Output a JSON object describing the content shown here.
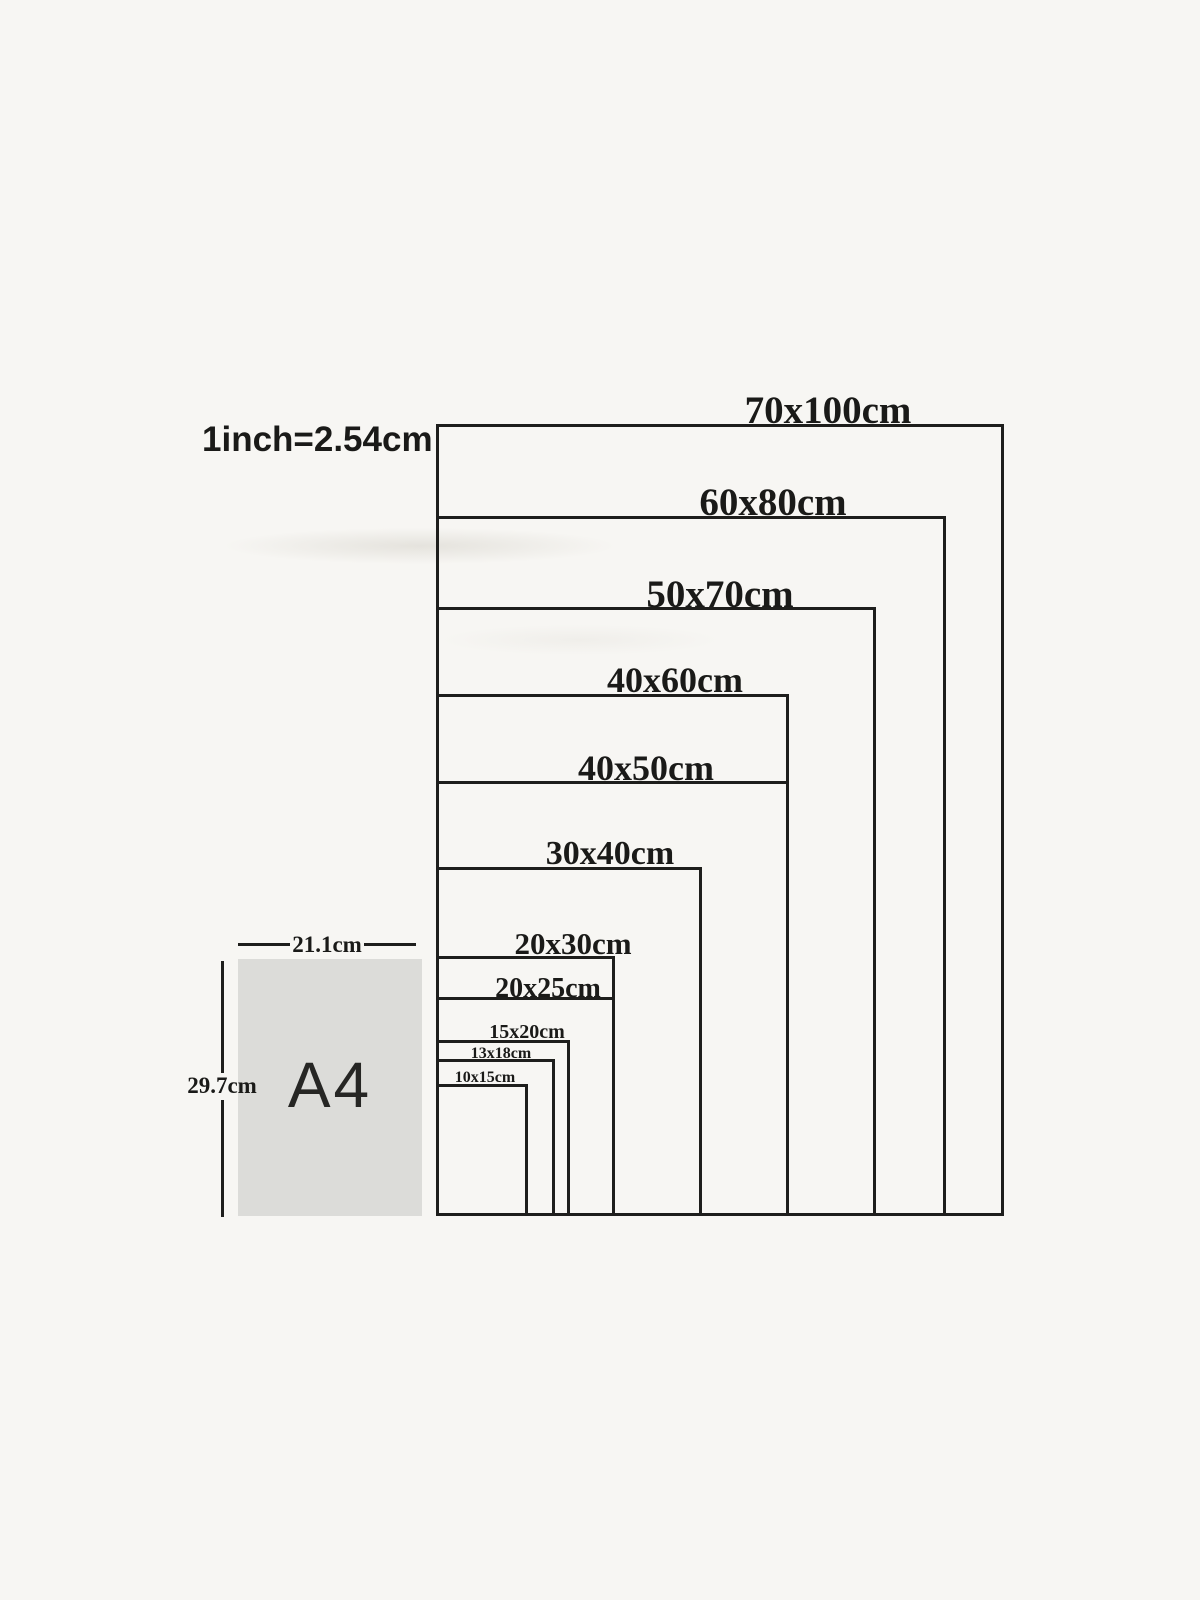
{
  "note": {
    "conversion": "1inch=2.54cm"
  },
  "diagram": {
    "unit": "cm",
    "sizes": [
      {
        "label": "70x100cm",
        "w_cm": 70,
        "h_cm": 100
      },
      {
        "label": "60x80cm",
        "w_cm": 60,
        "h_cm": 80
      },
      {
        "label": "50x70cm",
        "w_cm": 50,
        "h_cm": 70
      },
      {
        "label": "40x60cm",
        "w_cm": 40,
        "h_cm": 60
      },
      {
        "label": "40x50cm",
        "w_cm": 40,
        "h_cm": 50
      },
      {
        "label": "30x40cm",
        "w_cm": 30,
        "h_cm": 40
      },
      {
        "label": "20x30cm",
        "w_cm": 20,
        "h_cm": 30
      },
      {
        "label": "20x25cm",
        "w_cm": 20,
        "h_cm": 25
      },
      {
        "label": "15x20cm",
        "w_cm": 15,
        "h_cm": 20
      },
      {
        "label": "13x18cm",
        "w_cm": 13,
        "h_cm": 18
      },
      {
        "label": "10x15cm",
        "w_cm": 10,
        "h_cm": 15
      }
    ],
    "a4": {
      "label": "A4",
      "width_label": "21.1cm",
      "height_label": "29.7cm"
    }
  },
  "colors": {
    "background": "#f7f6f3",
    "line": "#1e1e1c",
    "text": "#1a1a18",
    "a4_fill": "#dcdcd9"
  }
}
